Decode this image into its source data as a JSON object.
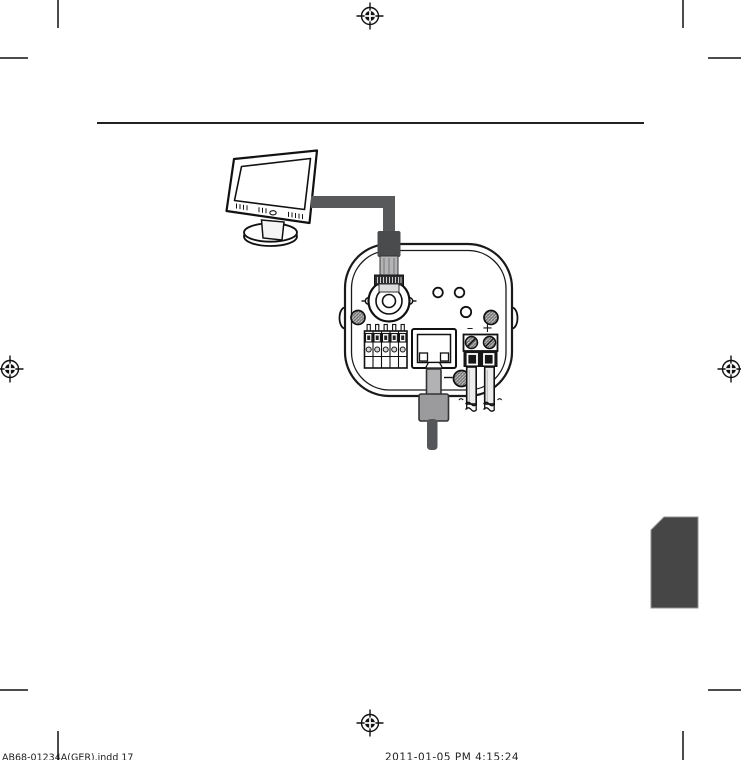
{
  "page": {
    "width": 741,
    "height": 760,
    "background": "#ffffff"
  },
  "colors": {
    "line": "#1a1a1a",
    "rule": "#222222",
    "cable": "#58595b",
    "bnc_boot": "#4a4b4d",
    "bnc_barrel": "#b4b4b6",
    "bnc_nut": "#2e2e30",
    "bnc_collar": "#dcdcde",
    "plug_tab": "#b2b2b4",
    "plug_body": "#9b9b9e",
    "plug_cable": "#55565a",
    "wire_fill": "#ececec",
    "power_block_dark": "#161616",
    "side_tab": "#464646",
    "screw_base": "#cfcfcf"
  },
  "diagram": {
    "camera": {
      "power_minus_label": "–",
      "power_plus_label": "+"
    }
  },
  "footer": {
    "left_text": "AB68-01234A(GER).indd   17",
    "center_text": "2011-01-05   PM 4:15:24"
  }
}
